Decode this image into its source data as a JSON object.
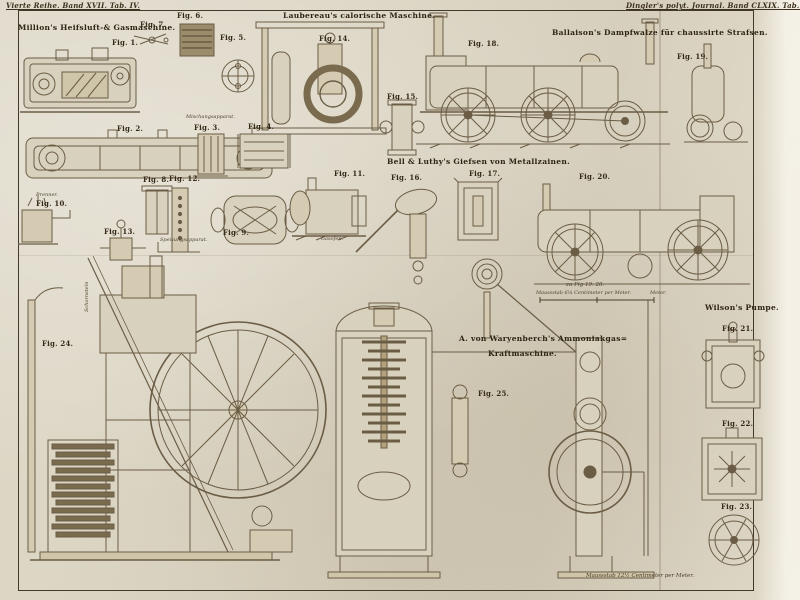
{
  "plate": {
    "paper_color": "#dad3c1",
    "ink_color": "#2e2719",
    "drawing_color": "#6b5d45"
  },
  "headers": {
    "left": "Vierte Reihe. Band XVII. Tab. IV.",
    "right": "Dingler's polyt. Journal. Band CLXIX. Tab. IV."
  },
  "titles": {
    "million": "Million's Heifsluft-& Gasmaschine.",
    "laubereau": "Laubereau's calorische Maschine.",
    "ballaison": "Ballaison's Dampfwalze für chaussirte Strafsen.",
    "bell": "Bell & Luthy's Giefsen von Metallzainen.",
    "ammonia_line1": "A. von Waryenberch's Ammoniakgas=",
    "ammonia_line2": "Kraftmaschine.",
    "wilson": "Wilson's Pumpe."
  },
  "figures": [
    "Fig. 1.",
    "Fig. 2.",
    "Fig. 3.",
    "Fig. 4.",
    "Fig. 5.",
    "Fig. 6.",
    "Fig. 7.",
    "Fig. 8.",
    "Fig. 9.",
    "Fig. 10.",
    "Fig. 11.",
    "Fig. 12.",
    "Fig. 13.",
    "Fig. 14.",
    "Fig. 15.",
    "Fig. 16.",
    "Fig. 17.",
    "Fig. 18.",
    "Fig. 19.",
    "Fig. 20.",
    "Fig. 21.",
    "Fig. 22.",
    "Fig. 23.",
    "Fig. 24.",
    "Fig. 25."
  ],
  "captions": {
    "mischungsapparat": "Mischungsapparat.",
    "brenner": "Brenner.",
    "speisungsapparat": "Speisungsapparat.",
    "gasofen": "Gasofen.",
    "schornstein": "Schornstein",
    "zu_fig": "zu Fig 19. 20.",
    "scale_small": "Maassstab 6¼ Centimeter per Meter.",
    "meter_label": "Meter.",
    "scale_bottom": "Maassstab 12½ Centimeter per Meter."
  }
}
